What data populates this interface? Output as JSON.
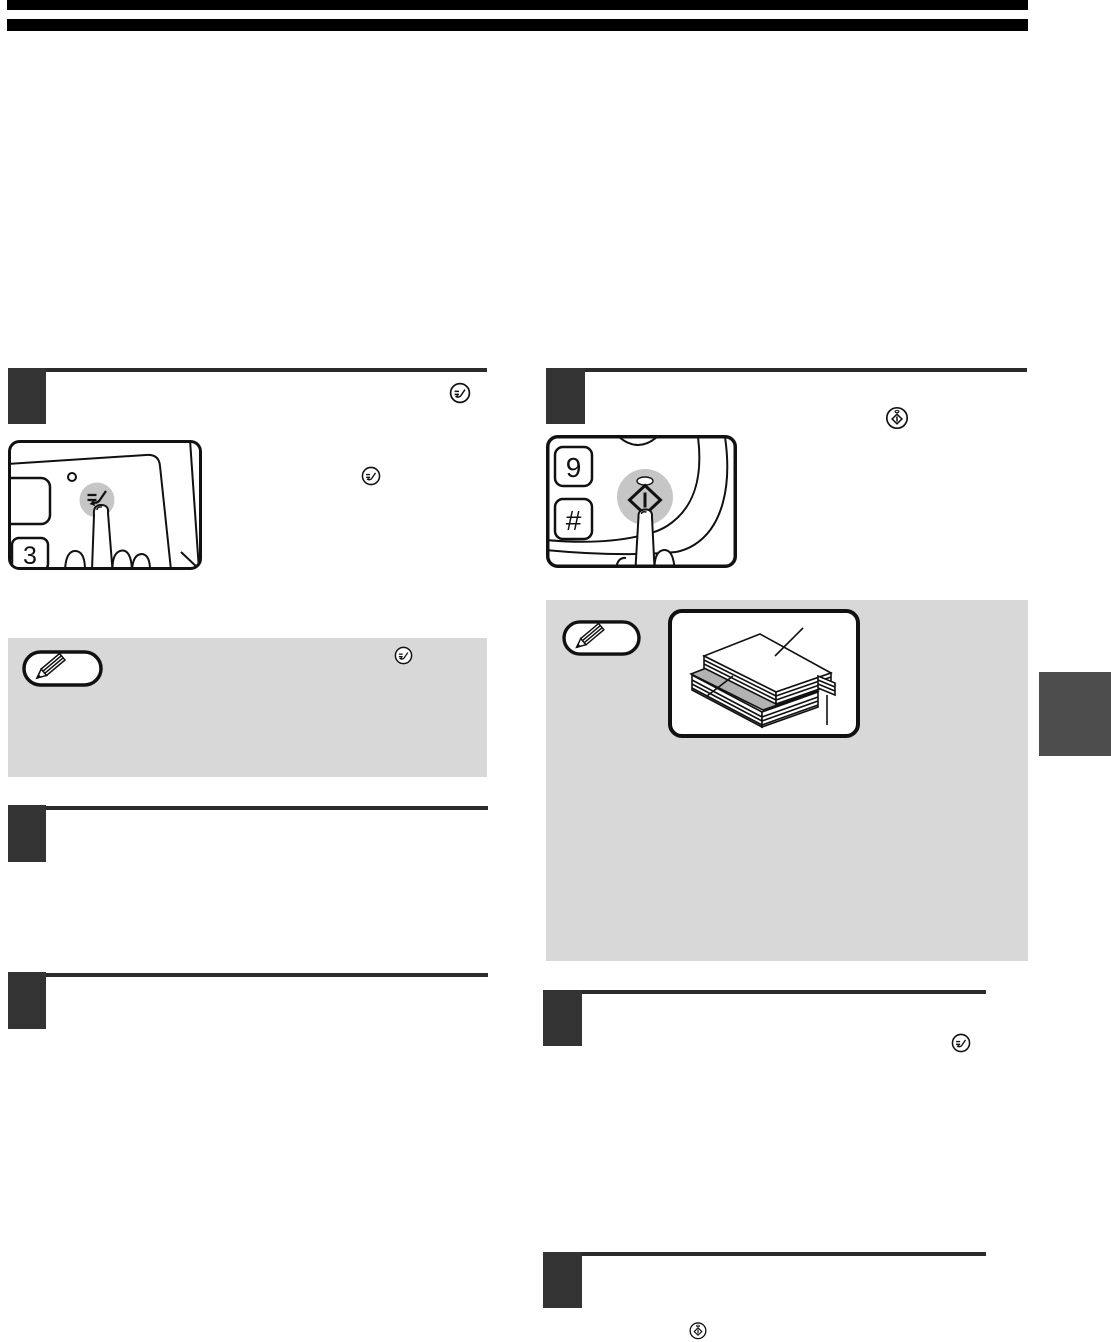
{
  "page": {
    "kind": "scanned copier manual page (graphics only, body text not rendered)",
    "colors": {
      "header_bar": "#000000",
      "step_square": "#333333",
      "step_rule": "#2b2b2b",
      "note_box_bg": "#d8d8d8",
      "side_tab": "#4d4d4d",
      "button_fill": "#c6c6c6",
      "insertion_sheet_gray": "#b2b2b2",
      "line_art": "#111111"
    }
  },
  "left_column": {
    "step1": {
      "panel_illustration": {
        "key_label": "3",
        "button_icon": "end-key-icon",
        "led": "small round indicator"
      },
      "inline_icon": "end-key-icon",
      "second_inline_icon": "end-key-icon"
    },
    "note": {
      "badge_icon": "pencil-icon",
      "inline_icon": "end-key-icon"
    }
  },
  "right_column": {
    "step1": {
      "panel_illustration": {
        "key_top_label": "9",
        "key_bottom_label": "#",
        "button_icon": "start-key-icon",
        "led": "oval indicator"
      },
      "inline_icon": "start-key-icon"
    },
    "note": {
      "badge_icon": "pencil-icon",
      "illustration": "paper stack with gray insertion sheet and callout lines"
    },
    "step2": {
      "inline_icon": "end-key-icon"
    },
    "step3": {
      "inline_icon": "start-key-icon"
    }
  },
  "icons": {
    "end_key": "circle containing two dashes and a check stroke (read-end key)",
    "start_key": "circle containing a diamond with vertical bar and a dot above (start key)",
    "pencil": "white pill badge with diagonal pencil (note marker)"
  }
}
